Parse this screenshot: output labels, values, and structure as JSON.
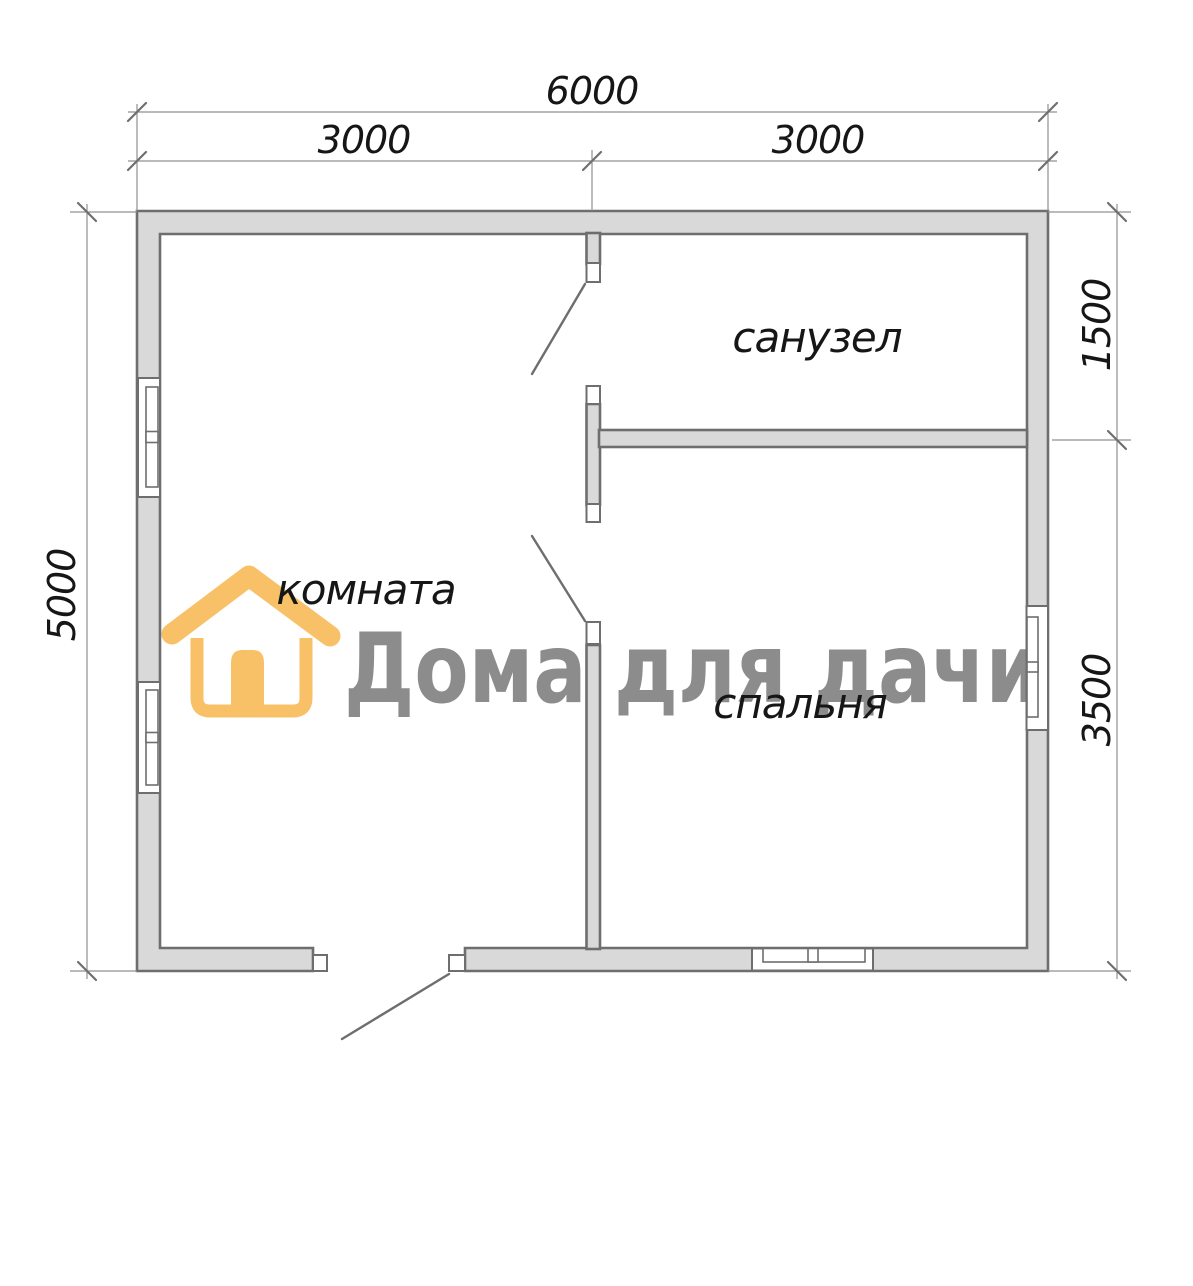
{
  "plan": {
    "dimensions": {
      "width_total": "6000",
      "width_left": "3000",
      "width_right": "3000",
      "height_total": "5000",
      "right_top": "1500",
      "right_bottom": "3500"
    },
    "rooms": {
      "room": "комната",
      "bathroom": "санузел",
      "bedroom": "спальня"
    }
  },
  "watermark": {
    "text": "Дома для дачи",
    "icon": "house-icon"
  },
  "colors": {
    "wall_fill": "#d9d9d9",
    "wall_stroke": "#6e6e6e",
    "line": "#909090",
    "label": "#161616",
    "watermark_gray": "#8c8c8c",
    "watermark_orange": "#f8c168"
  }
}
